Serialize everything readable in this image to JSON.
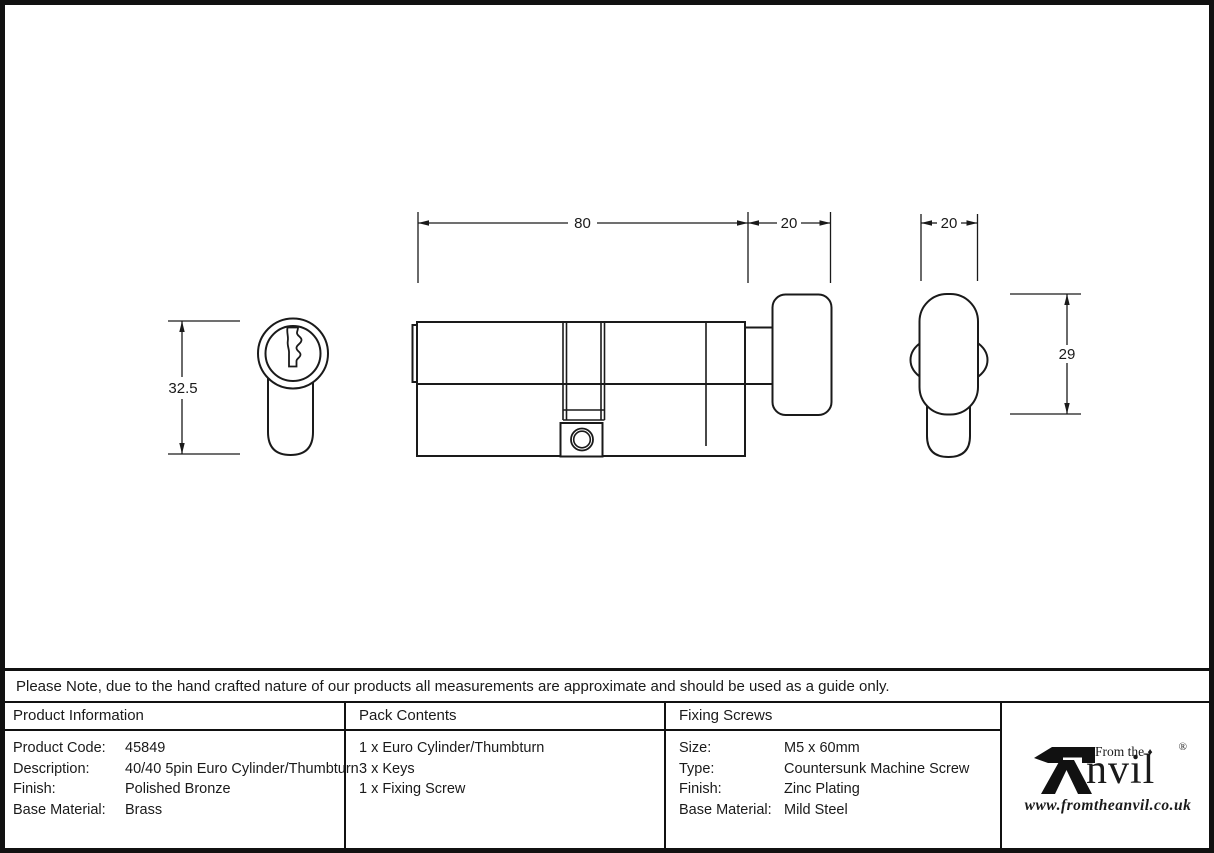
{
  "note": "Please Note, due to the hand crafted nature of our products all measurements are approximate and should be used as a guide only.",
  "drawing": {
    "dims": {
      "body_length": "80",
      "thumbturn_depth": "20",
      "thumbturn_width": "20",
      "face_height": "32.5",
      "thumbturn_height": "29"
    }
  },
  "table": {
    "product_information": {
      "header": "Product Information",
      "rows": [
        {
          "label": "Product Code:",
          "value": "45849"
        },
        {
          "label": "Description:",
          "value": "40/40 5pin Euro Cylinder/Thumbturn"
        },
        {
          "label": "Finish:",
          "value": "Polished Bronze"
        },
        {
          "label": "Base Material:",
          "value": "Brass"
        }
      ]
    },
    "pack_contents": {
      "header": "Pack Contents",
      "items": [
        "1 x Euro Cylinder/Thumbturn",
        "3 x Keys",
        "1 x Fixing Screw"
      ]
    },
    "fixing_screws": {
      "header": "Fixing Screws",
      "rows": [
        {
          "label": "Size:",
          "value": "M5 x 60mm"
        },
        {
          "label": "Type:",
          "value": "Countersunk Machine Screw"
        },
        {
          "label": "Finish:",
          "value": "Zinc Plating"
        },
        {
          "label": "Base Material:",
          "value": "Mild Steel"
        }
      ]
    }
  },
  "logo": {
    "from_the": "From the",
    "diamond": "♦",
    "name_rest": "nvil",
    "registered": "®",
    "url": "www.fromtheanvil.co.uk"
  },
  "colors": {
    "line": "#1a1a1a",
    "background": "#ffffff"
  }
}
